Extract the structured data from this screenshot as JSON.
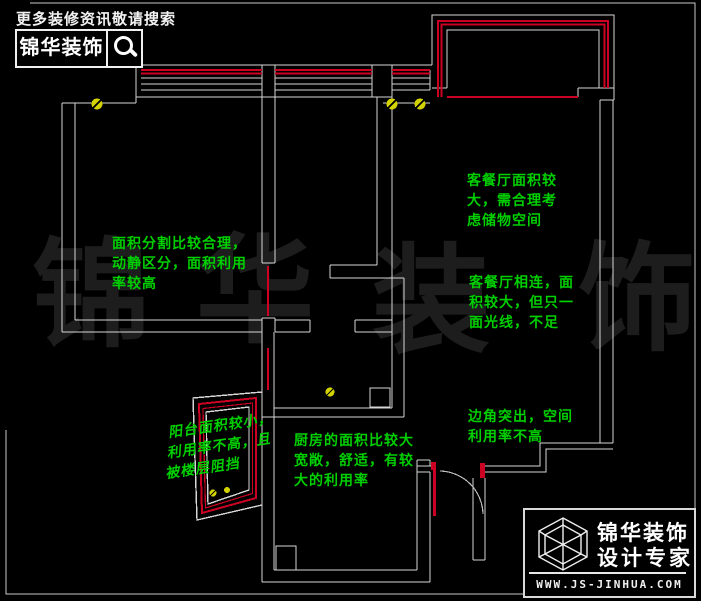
{
  "header": {
    "tagline": "更多装修资讯敬请搜索",
    "brand": "锦华装饰",
    "search_icon": "magnifier"
  },
  "watermark": {
    "chars": [
      "锦",
      "华",
      "装",
      "饰"
    ]
  },
  "annotations": {
    "bedroom": {
      "text": "面积分割比较合理，\n动静区分，面积利用\n率较高"
    },
    "storage": {
      "text": "客餐厅面积较\n大，需合理考\n虑储物空间"
    },
    "living": {
      "text": "客餐厅相连，面\n积较大，但只一\n面光线，不足"
    },
    "corner": {
      "text": "边角突出，空间\n利用率不高"
    },
    "kitchen": {
      "text": "厨房的面积比较大\n宽敞，舒适，有较\n大的利用率"
    },
    "balcony": {
      "text": "阳台面积较小，\n利用率不高，且\n被楼层阻挡"
    }
  },
  "footer_logo": {
    "brand_line1": "锦华装饰",
    "brand_line2": "设计专家",
    "website": "WWW.JS-JINHUA.COM"
  },
  "colors": {
    "background": "#000000",
    "wall_line": "#d6d6d6",
    "accent_red": "#cc0022",
    "annotation_green": "#00cf00",
    "symbol_yellow": "#d2d200",
    "watermark_gray": "#1d1d1d"
  }
}
